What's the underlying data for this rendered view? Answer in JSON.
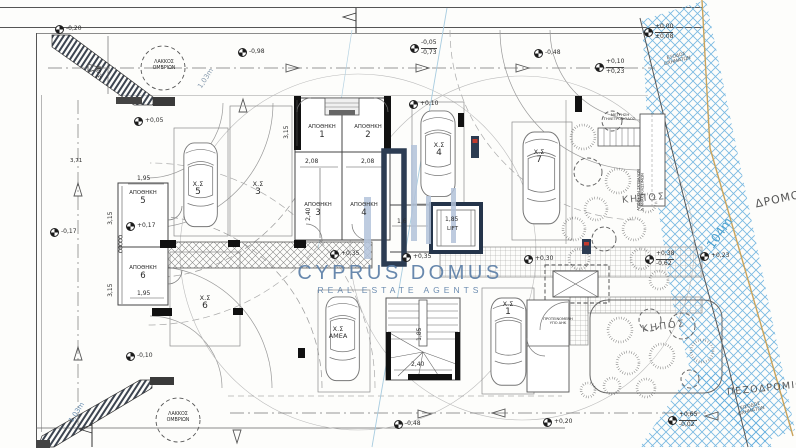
{
  "watermark": {
    "brand": "CYPRUS DOMUS",
    "tagline": "REAL ESTATE AGENTS",
    "brand_color": "#5d80a8",
    "bar_dark": "#2c3c52",
    "bar_light": "#b3c3da"
  },
  "site": {
    "road": "ΔΡΟΜΟΣ",
    "road_length": "104m",
    "sidewalk": "ΠΕΖΟΔΡΟΜΙΟ",
    "vehicle_exit": "ΕΞΟΔΟΣ ΟΧΗΜΑΤΩΝ",
    "vehicle_entrance": "ΕΙΣΟΔΟΣ ΟΧΗΜΑΤΩΝ",
    "garden": "ΚΗΠΟΣ",
    "rain_pit": "ΛΑΚΚΟΣ ΟΜΒΡΙΩΝ",
    "ramp_length": "1,03m"
  },
  "rooms": {
    "storage": "ΑΠΟΘΗΚΗ",
    "lift": "LIFT",
    "meters": "ΜΕΤΡΗΣΗ ΤΗΛΕΤΡΟΦΟΔΟΣ.",
    "waste": "ΑΠΟΘΗΚΗ ΣΚΥΒΑΛΩΝ",
    "waste2": "& ΑΝΑΚΥΚΛΩΣΙΜΩΝ",
    "substation": "ΠΡΟΤΕΙΝΟΜΕΝΗ",
    "substation2": "ΥΠΟ ΑΗΚ"
  },
  "storage_units": [
    "1",
    "2",
    "3",
    "4",
    "5",
    "6"
  ],
  "parking": {
    "prefix": "Χ.Σ",
    "spaces": [
      "1",
      "3",
      "4",
      "5",
      "6",
      "7",
      "ΑΜΕΑ"
    ]
  },
  "levels": [
    "-0,20",
    "+0,05",
    "-0,98",
    "-0,05",
    "-0,73",
    "-0,48",
    "+0,10",
    "+0,23",
    "±0,00",
    "±0,08",
    "+0,10",
    "+0,17",
    "-0,17",
    "+0,35",
    "+0,35",
    "+0,30",
    "+0,38",
    "-0,62",
    "+0,23",
    "-0,10",
    "-0,48",
    "+0,20",
    "+0,65",
    "-0,02"
  ],
  "dims": [
    "3,00",
    "3,71",
    "1,95",
    "3,15",
    "3,15",
    "1,95",
    "2,08",
    "2,08",
    "3,15",
    "2,40",
    "1,6",
    "1,85",
    "2,40",
    "1,85"
  ],
  "colors": {
    "road_hatch": "#63aede",
    "boundary_tan": "#c9a35c",
    "column_red": "#c23b2e"
  }
}
